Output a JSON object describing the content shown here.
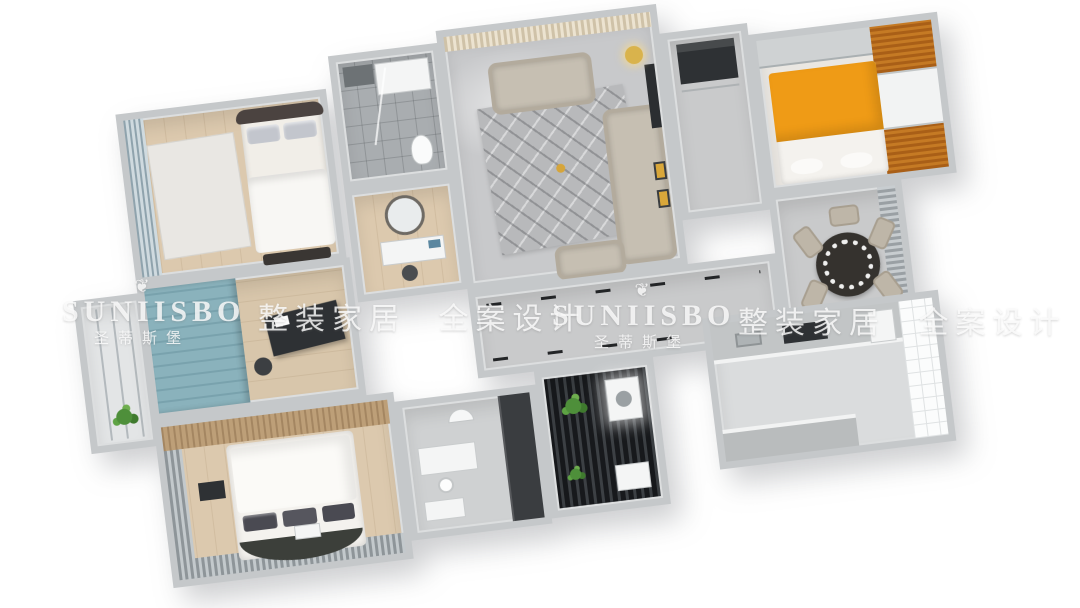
{
  "watermarks": {
    "brand": "SUNIISBO",
    "brand_cn": "圣蒂斯堡",
    "slogan": "整装家居 全案设计",
    "logo_glyph": "❦",
    "color": "rgba(252,252,252,0.82)"
  },
  "scene": {
    "type": "3d-isometric-floorplan-render",
    "rotation_deg": -7,
    "rooms": [
      {
        "name": "secondary-bedroom",
        "features": [
          "double-bed",
          "window-curtains",
          "white-rug"
        ]
      },
      {
        "name": "shower-bathroom",
        "features": [
          "shower-tray",
          "toilet",
          "glass-partition"
        ]
      },
      {
        "name": "vanity-room",
        "features": [
          "round-mirror",
          "washbasin-counter",
          "blue-towels"
        ]
      },
      {
        "name": "living-room",
        "features": [
          "loveseat",
          "long-sofa",
          "geometric-rug",
          "floor-lamp",
          "tv-wall",
          "gold-art"
        ]
      },
      {
        "name": "entry-hall",
        "features": [
          "dark-shoe-cabinet"
        ]
      },
      {
        "name": "kids-bedroom",
        "features": [
          "orange-bed",
          "orange-wood-wardrobe",
          "desk"
        ]
      },
      {
        "name": "side-balcony",
        "features": [
          "glass-wall",
          "plant"
        ]
      },
      {
        "name": "study",
        "features": [
          "teal-cabinet-wall",
          "dark-desk",
          "chair"
        ]
      },
      {
        "name": "corridor",
        "features": [
          "dashed-tile-marks"
        ]
      },
      {
        "name": "dining-area",
        "features": [
          "round-black-table",
          "six-chairs",
          "window-blinds"
        ]
      },
      {
        "name": "master-bedroom",
        "features": [
          "large-white-bed",
          "patterned-pillows",
          "wood-headboard-wall",
          "gray-curtains"
        ]
      },
      {
        "name": "home-office",
        "features": [
          "white-desk",
          "dark-wardrobe",
          "white-cabinet"
        ]
      },
      {
        "name": "laundry-balcony",
        "features": [
          "dark-deck-floor",
          "plants",
          "washing-machine"
        ]
      },
      {
        "name": "kitchen",
        "features": [
          "tiled-wall",
          "counter-run",
          "cooktop",
          "fridge"
        ]
      }
    ],
    "palette": {
      "background": "#ffffff",
      "wall": "#c5c8ca",
      "wood_floor": "#dcc9ae",
      "marble_floor": "#c8c9cb",
      "accent_orange": "#ef9b16",
      "accent_teal": "#8ab2bc",
      "dark_furniture": "#2e3134",
      "sofa_beige": "#c6bfb2",
      "deck_dark": "#17191c"
    }
  }
}
